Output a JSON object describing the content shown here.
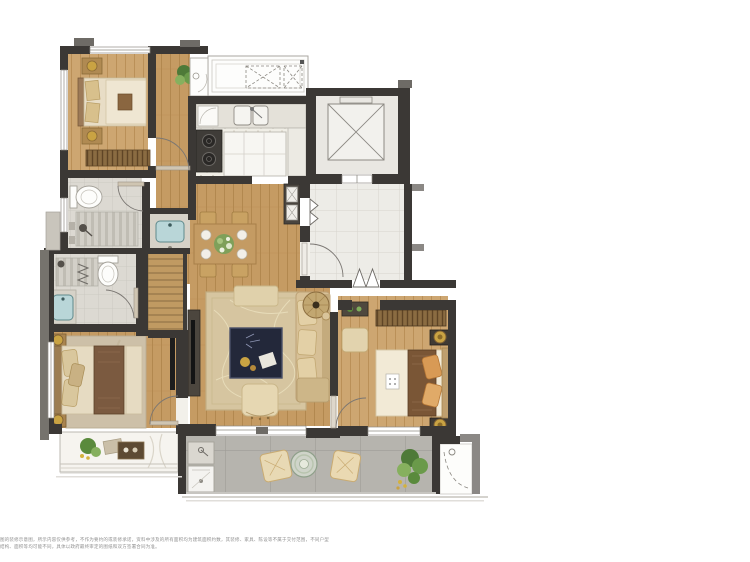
{
  "disclaimer": {
    "line1": "图的装修示意图，所示内容仅供参考，不作为要约的或装修承诺，资料中涉及的所有面积均为建筑面积约数，其装修、家具、陈设等不属于交付范围，不同户型",
    "line2": "结构、面积等均可能不同，具体以政府最终审定的图纸和双方签署合同为准。"
  },
  "palette": {
    "wall_dark": "#3b3835",
    "wall_gray": "#6e6b66",
    "wood_floor": "#c59b63",
    "foyer_tile": "#edece7",
    "bath_tile": "#dcd9d2",
    "balcony_tile": "#b6b4ae",
    "living_rug": "#d6c5a0",
    "coffee_table_navy": "#23283a",
    "gold_accent": "#c9a343",
    "bed_runner_brown": "#7b5a40",
    "basin_blue": "#b9d6d8",
    "greenery": "#5a8a3c"
  }
}
